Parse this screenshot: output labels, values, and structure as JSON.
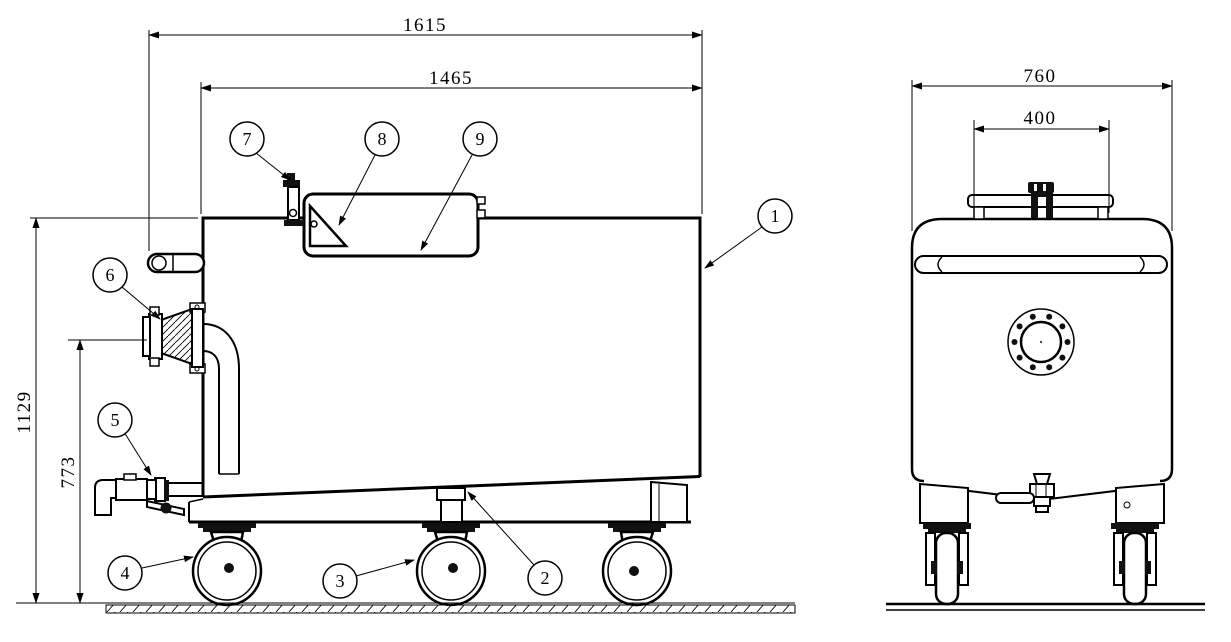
{
  "colors": {
    "background": "#ffffff",
    "line": "#000000"
  },
  "views": {
    "side": {
      "dimensions": {
        "overall_length": "1615",
        "body_length": "1465",
        "overall_height": "1129",
        "outlet_height": "773"
      },
      "callouts": [
        "1",
        "2",
        "3",
        "4",
        "5",
        "6",
        "7",
        "8",
        "9"
      ]
    },
    "front": {
      "dimensions": {
        "overall_width": "760",
        "hatch_width": "400"
      }
    }
  }
}
